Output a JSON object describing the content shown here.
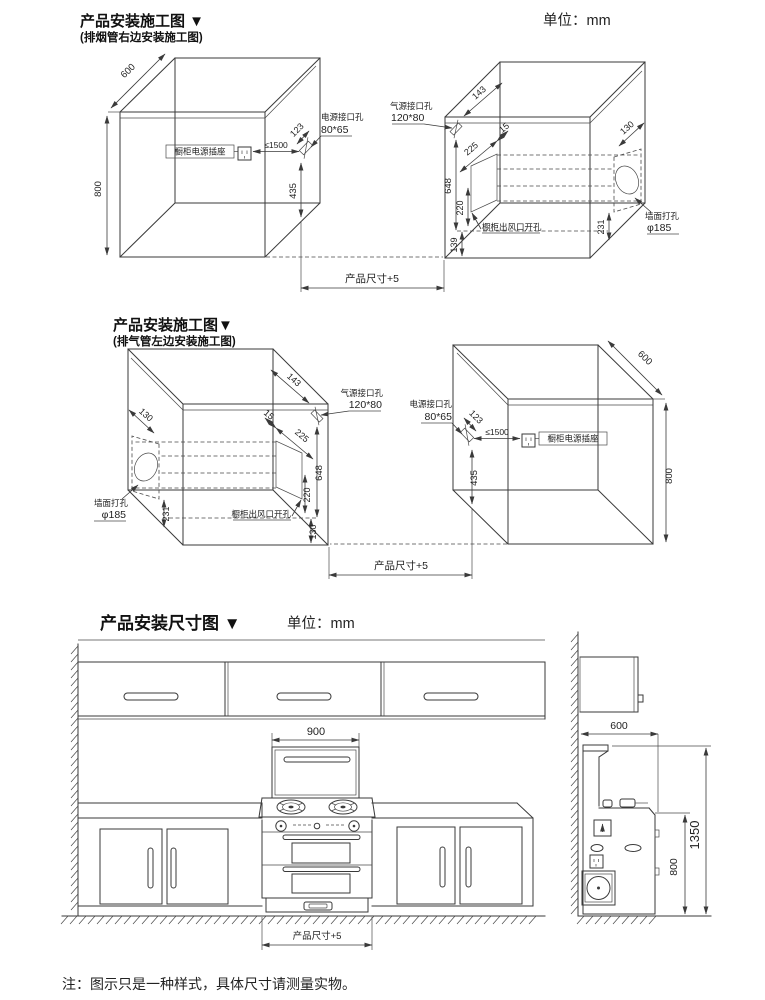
{
  "page": {
    "unit_top": "单位：mm",
    "note": "注：图示只是一种样式，具体尺寸请测量实物。"
  },
  "section1": {
    "title": "产品安装施工图 ▼",
    "subtitle": "(排烟管右边安装施工图)"
  },
  "section2": {
    "title": "产品安装施工图▼",
    "subtitle": "(排气管左边安装施工图)"
  },
  "section3": {
    "title": "产品安装尺寸图 ▼",
    "unit": "单位：mm"
  },
  "dims": {
    "depth": "600",
    "height": "800",
    "socket_label": "橱柜电源插座",
    "socket_dist": "≤1500",
    "power_hole_name": "电源接口孔",
    "power_hole_size": "80*65",
    "power_hole_top": "123",
    "power_hole_bottom": "435",
    "gas_hole_name": "气源接口孔",
    "gas_hole_size": "120*80",
    "duct_from_front": "143",
    "duct_gap": "15",
    "duct_width": "225",
    "duct_top": "648",
    "duct_height": "220",
    "duct_bottom_s1": "139",
    "duct_bottom_s2": "130",
    "wall_hole_offset": "130",
    "wall_hole_bottom": "231",
    "vent_cut_label": "橱柜出风口开孔",
    "wall_hole_name": "墙面打孔",
    "wall_hole_dia": "φ185",
    "product_width": "产品尺寸+5"
  },
  "elevation": {
    "hood_width": "900",
    "product_width": "产品尺寸+5",
    "side_depth": "600",
    "side_height": "800",
    "side_total_height": "1350"
  }
}
